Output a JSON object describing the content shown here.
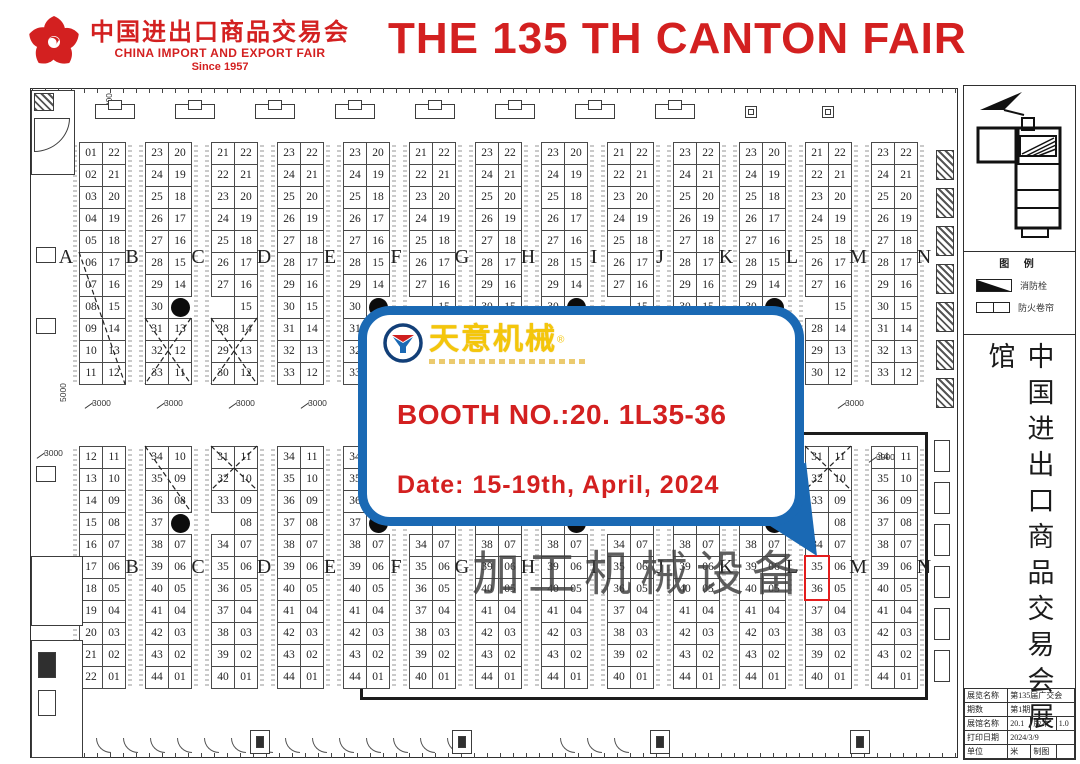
{
  "colors": {
    "red": "#d32020",
    "blue": "#1a69b4",
    "gold": "#f4c60a",
    "highlight": "#e31d1d"
  },
  "header": {
    "logo_cn": "中国进出口商品交易会",
    "logo_en": "CHINA IMPORT AND EXPORT FAIR",
    "logo_since": "Since 1957",
    "title": "THE 135 TH CANTON FAIR"
  },
  "callout": {
    "brand": "天意机械",
    "reg_mark": "®",
    "booth_line": "BOOTH NO.:20. 1L35-36",
    "date_line": "Date: 15-19th, April, 2024"
  },
  "watermark": "加工机械设备",
  "sidebar": {
    "legend": {
      "title": "图 例",
      "items": [
        {
          "symbol": "wedge-icon",
          "label": "消防栓"
        },
        {
          "symbol": "shutter-icon",
          "label": "防火卷帘"
        }
      ]
    },
    "vertical_title": "中国进出口商品交易会展馆",
    "info_table": {
      "rows": [
        {
          "cells": [
            {
              "t": "展览名称"
            },
            {
              "t": "第135届广交会",
              "span": 3
            }
          ]
        },
        {
          "cells": [
            {
              "t": "期数"
            },
            {
              "t": "第1期",
              "span": 3
            }
          ]
        },
        {
          "cells": [
            {
              "t": "展馆名称"
            },
            {
              "t": "20.1"
            },
            {
              "t": "版本"
            },
            {
              "t": "1.0"
            }
          ]
        },
        {
          "cells": [
            {
              "t": "打印日期"
            },
            {
              "t": "2024/3/9",
              "span": 3
            }
          ]
        },
        {
          "cells": [
            {
              "t": "单位"
            },
            {
              "t": "米"
            },
            {
              "t": "制图"
            },
            {
              "t": ""
            }
          ]
        }
      ]
    }
  },
  "plan": {
    "letters": [
      "A",
      "B",
      "C",
      "D",
      "E",
      "F",
      "G",
      "H",
      "I",
      "J",
      "K",
      "L",
      "M",
      "N"
    ],
    "top_pairs": [
      {
        "left": [
          "01",
          "02",
          "03",
          "04",
          "05",
          "06",
          "07",
          "08",
          "09",
          "10",
          "11"
        ],
        "right": [
          "22",
          "21",
          "20",
          "19",
          "18",
          "17",
          "16",
          "15",
          "14",
          "13",
          "12"
        ]
      },
      {
        "left": [
          "23",
          "24",
          "25",
          "26",
          "27",
          "28",
          "29",
          "30",
          "31",
          "32",
          "33"
        ],
        "right": [
          "20",
          "19",
          "18",
          "17",
          "16",
          "15",
          "14",
          "DOT",
          "13",
          "12",
          "11"
        ]
      },
      {
        "left": [
          "21",
          "22",
          "23",
          "24",
          "25",
          "26",
          "27",
          null,
          "28",
          "29",
          "30"
        ],
        "right": [
          "22",
          "21",
          "20",
          "19",
          "18",
          "17",
          "16",
          "15",
          "14",
          "13",
          "12"
        ]
      },
      {
        "left": [
          "23",
          "24",
          "25",
          "26",
          "27",
          "28",
          "29",
          "30",
          "31",
          "32",
          "33"
        ],
        "right": [
          "22",
          "21",
          "20",
          "19",
          "18",
          "17",
          "16",
          "15",
          "14",
          "13",
          "12"
        ]
      },
      {
        "left": [
          "23",
          "24",
          "25",
          "26",
          "27",
          "28",
          "29",
          "30",
          "31",
          "32",
          "33"
        ],
        "right": [
          "20",
          "19",
          "18",
          "17",
          "16",
          "15",
          "14",
          "DOT",
          "13",
          "12",
          "11"
        ]
      },
      {
        "left": [
          "21",
          "22",
          "23",
          "24",
          "25",
          "26",
          "27",
          null,
          "28",
          "29",
          "30"
        ],
        "right": [
          "22",
          "21",
          "20",
          "19",
          "18",
          "17",
          "16",
          "15",
          "14",
          "13",
          "12"
        ]
      },
      {
        "left": [
          "23",
          "24",
          "25",
          "26",
          "27",
          "28",
          "29",
          "30",
          "31",
          "32",
          "33"
        ],
        "right": [
          "22",
          "21",
          "20",
          "19",
          "18",
          "17",
          "16",
          "15",
          "14",
          "13",
          "12"
        ]
      },
      {
        "left": [
          "23",
          "24",
          "25",
          "26",
          "27",
          "28",
          "29",
          "30",
          "31",
          "32",
          "33"
        ],
        "right": [
          "20",
          "19",
          "18",
          "17",
          "16",
          "15",
          "14",
          "DOT",
          "13",
          "12",
          "11"
        ]
      },
      {
        "left": [
          "21",
          "22",
          "23",
          "24",
          "25",
          "26",
          "27",
          null,
          "28",
          "29",
          "30"
        ],
        "right": [
          "22",
          "21",
          "20",
          "19",
          "18",
          "17",
          "16",
          "15",
          "14",
          "13",
          "12"
        ]
      },
      {
        "left": [
          "23",
          "24",
          "25",
          "26",
          "27",
          "28",
          "29",
          "30",
          "31",
          "32",
          "33"
        ],
        "right": [
          "22",
          "21",
          "20",
          "19",
          "18",
          "17",
          "16",
          "15",
          "14",
          "13",
          "12"
        ]
      },
      {
        "left": [
          "23",
          "24",
          "25",
          "26",
          "27",
          "28",
          "29",
          "30",
          "31",
          "32",
          "33"
        ],
        "right": [
          "20",
          "19",
          "18",
          "17",
          "16",
          "15",
          "14",
          "DOT",
          "13",
          "12",
          "11"
        ]
      },
      {
        "left": [
          "21",
          "22",
          "23",
          "24",
          "25",
          "26",
          "27",
          null,
          "28",
          "29",
          "30"
        ],
        "right": [
          "22",
          "21",
          "20",
          "19",
          "18",
          "17",
          "16",
          "15",
          "14",
          "13",
          "12"
        ]
      },
      {
        "left": [
          "23",
          "24",
          "25",
          "26",
          "27",
          "28",
          "29",
          "30",
          "31",
          "32",
          "33"
        ],
        "right": [
          "22",
          "21",
          "20",
          "19",
          "18",
          "17",
          "16",
          "15",
          "14",
          "13",
          "12"
        ]
      }
    ],
    "bottom_pairs": [
      {
        "left": [
          "12",
          "13",
          "14",
          "15",
          "16",
          "17",
          "18",
          "19",
          "20",
          "21",
          "22"
        ],
        "right": [
          "11",
          "10",
          "09",
          "08",
          "07",
          "06",
          "05",
          "04",
          "03",
          "02",
          "01"
        ]
      },
      {
        "left": [
          "34",
          "35",
          "36",
          "37",
          "38",
          "39",
          "40",
          "41",
          "42",
          "43",
          "44"
        ],
        "right": [
          "10",
          "09",
          "08",
          "DOT",
          "07",
          "06",
          "05",
          "04",
          "03",
          "02",
          "01"
        ]
      },
      {
        "left": [
          "31",
          "32",
          "33",
          null,
          "34",
          "35",
          "36",
          "37",
          "38",
          "39",
          "40"
        ],
        "right": [
          "11",
          "10",
          "09",
          "08",
          "07",
          "06",
          "05",
          "04",
          "03",
          "02",
          "01"
        ]
      },
      {
        "left": [
          "34",
          "35",
          "36",
          "37",
          "38",
          "39",
          "40",
          "41",
          "42",
          "43",
          "44"
        ],
        "right": [
          "11",
          "10",
          "09",
          "08",
          "07",
          "06",
          "05",
          "04",
          "03",
          "02",
          "01"
        ]
      },
      {
        "left": [
          "34",
          "35",
          "36",
          "37",
          "38",
          "39",
          "40",
          "41",
          "42",
          "43",
          "44"
        ],
        "right": [
          "10",
          "09",
          "08",
          "DOT",
          "07",
          "06",
          "05",
          "04",
          "03",
          "02",
          "01"
        ]
      },
      {
        "left": [
          "31",
          "32",
          "33",
          null,
          "34",
          "35",
          "36",
          "37",
          "38",
          "39",
          "40"
        ],
        "right": [
          "11",
          "10",
          "09",
          "08",
          "07",
          "06",
          "05",
          "04",
          "03",
          "02",
          "01"
        ]
      },
      {
        "left": [
          "34",
          "35",
          "36",
          "37",
          "38",
          "39",
          "40",
          "41",
          "42",
          "43",
          "44"
        ],
        "right": [
          "11",
          "10",
          "09",
          "08",
          "07",
          "06",
          "05",
          "04",
          "03",
          "02",
          "01"
        ]
      },
      {
        "left": [
          "34",
          "35",
          "36",
          "37",
          "38",
          "39",
          "40",
          "41",
          "42",
          "43",
          "44"
        ],
        "right": [
          "10",
          "09",
          "08",
          "DOT",
          "07",
          "06",
          "05",
          "04",
          "03",
          "02",
          "01"
        ]
      },
      {
        "left": [
          "31",
          "32",
          "33",
          null,
          "34",
          "35",
          "36",
          "37",
          "38",
          "39",
          "40"
        ],
        "right": [
          "11",
          "10",
          "09",
          "08",
          "07",
          "06",
          "05",
          "04",
          "03",
          "02",
          "01"
        ]
      },
      {
        "left": [
          "34",
          "35",
          "36",
          "37",
          "38",
          "39",
          "40",
          "41",
          "42",
          "43",
          "44"
        ],
        "right": [
          "11",
          "10",
          "09",
          "08",
          "07",
          "06",
          "05",
          "04",
          "03",
          "02",
          "01"
        ]
      },
      {
        "left": [
          "34",
          "35",
          "36",
          "37",
          "38",
          "39",
          "40",
          "41",
          "42",
          "43",
          "44"
        ],
        "right": [
          "10",
          "09",
          "08",
          "DOT",
          "07",
          "06",
          "05",
          "04",
          "03",
          "02",
          "01"
        ]
      },
      {
        "left": [
          "31",
          "32",
          "33",
          null,
          "34",
          "35",
          "36",
          "37",
          "38",
          "39",
          "40"
        ],
        "right": [
          "11",
          "10",
          "09",
          "08",
          "07",
          "06",
          "05",
          "04",
          "03",
          "02",
          "01"
        ]
      },
      {
        "left": [
          "34",
          "35",
          "36",
          "37",
          "38",
          "39",
          "40",
          "41",
          "42",
          "43",
          "44"
        ],
        "right": [
          "11",
          "10",
          "09",
          "08",
          "07",
          "06",
          "05",
          "04",
          "03",
          "02",
          "01"
        ]
      }
    ],
    "highlight": {
      "section": "bottom",
      "pair": 11,
      "side": "left",
      "rows": [
        5,
        6
      ],
      "booths": [
        "35",
        "36"
      ]
    },
    "diagonals": {
      "top": [
        {
          "pair": 0,
          "r1": 5,
          "r2": 10,
          "cross": false
        },
        {
          "pair": 1,
          "r1": 8,
          "r2": 10,
          "cross": true
        },
        {
          "pair": 2,
          "r1": 8,
          "r2": 10,
          "cross": true
        }
      ],
      "bottom": [
        {
          "pair": 1,
          "r1": 0,
          "r2": 2,
          "cross": false
        },
        {
          "pair": 2,
          "r1": 0,
          "r2": 1,
          "cross": true
        },
        {
          "pair": 11,
          "r1": 0,
          "r2": 1,
          "cross": true
        }
      ]
    },
    "dimension_labels": [
      {
        "t": "3000",
        "x": 92,
        "y": 398,
        "vert": false
      },
      {
        "t": "3000",
        "x": 164,
        "y": 398,
        "vert": false
      },
      {
        "t": "3000",
        "x": 236,
        "y": 398,
        "vert": false
      },
      {
        "t": "3000",
        "x": 308,
        "y": 398,
        "vert": false
      },
      {
        "t": "3000",
        "x": 845,
        "y": 398,
        "vert": false
      },
      {
        "t": "3000",
        "x": 876,
        "y": 452,
        "vert": false
      },
      {
        "t": "3000",
        "x": 44,
        "y": 448,
        "vert": false
      },
      {
        "t": "5000",
        "x": 58,
        "y": 402,
        "vert": true
      },
      {
        "t": "5000",
        "x": 104,
        "y": 112,
        "vert": true
      }
    ]
  }
}
